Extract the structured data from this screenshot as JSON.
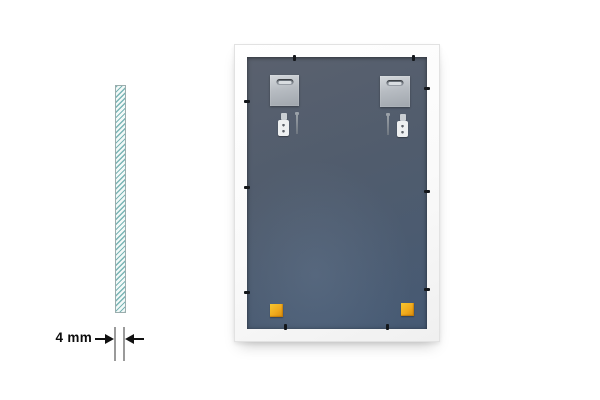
{
  "dimension": {
    "label": "4 mm"
  },
  "components": {
    "glass_cross_section": "glass-cross-section",
    "frame_back": "mirror-frame-back",
    "hanger_plates": 2,
    "wall_anchor_sets": 2,
    "retaining_clips": 10,
    "corner_pads": 2
  },
  "colors": {
    "background": "#ffffff",
    "glass_fill": "#f2f9f8",
    "glass_hatch": "#7ab5b5",
    "glass_border": "#9badad",
    "dimension_line": "#9a9a9a",
    "arrow_color": "#111111",
    "label_color": "#0c0c0c",
    "frame_face": "#fafafa",
    "frame_outline": "#e2e2e2",
    "panel_top": "#5a616e",
    "panel_bottom": "#465a74",
    "plate_metal": "#b7bcc2",
    "clip_color": "#14171b",
    "pad_orange": "#f0a91c"
  }
}
